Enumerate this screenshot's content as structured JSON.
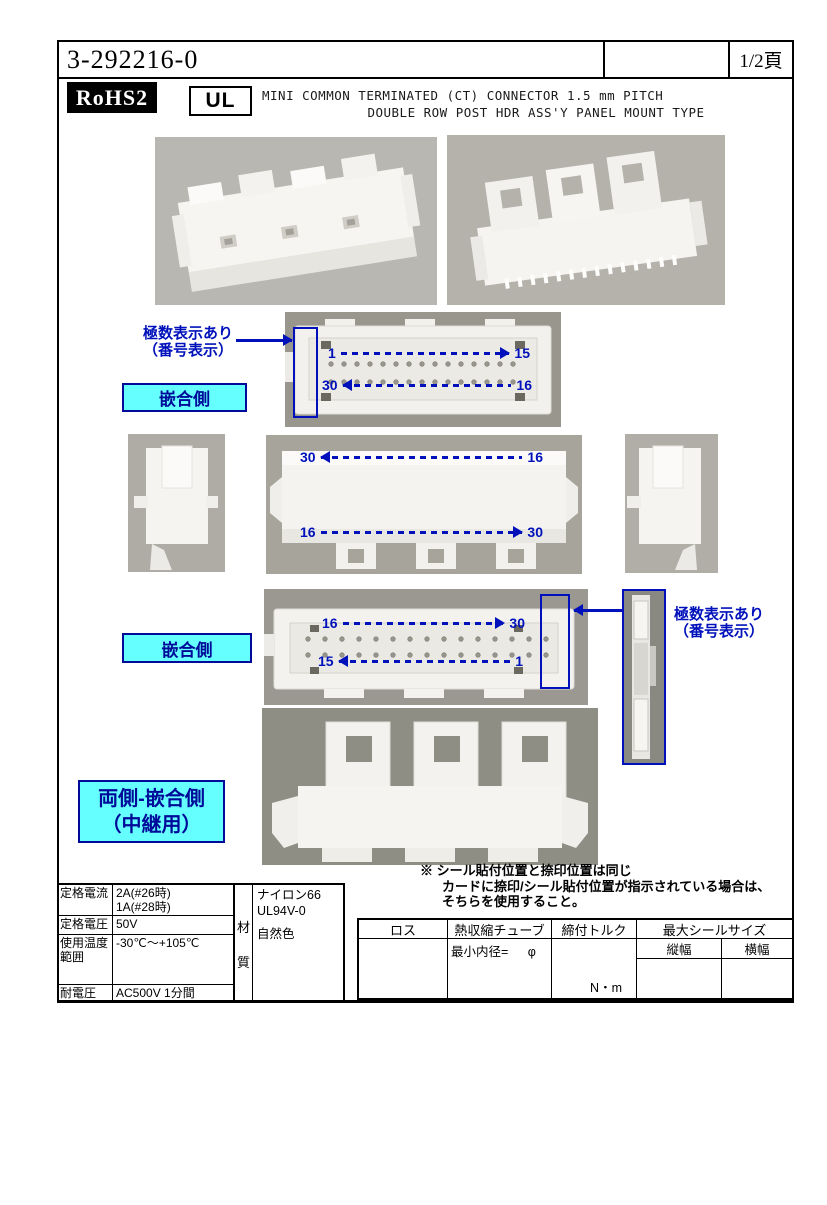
{
  "colors": {
    "accent_blue": "#0011bb",
    "cyan_fill": "#66ffff",
    "page_bg": "#ffffff"
  },
  "header": {
    "part_number": "3-292216-0",
    "page_label": "1/2頁"
  },
  "title_block": {
    "rohs": "RoHS2",
    "ul": "UL",
    "line1": "MINI COMMON TERMINATED (CT) CONNECTOR 1.5 mm PITCH",
    "line2": "DOUBLE ROW POST HDR ASS'Y PANEL MOUNT TYPE"
  },
  "annotations": {
    "pole_marking_line1": "極数表示あり",
    "pole_marking_line2": "（番号表示）",
    "mating_side": "嵌合側",
    "both_sides_line1": "両側-嵌合側",
    "both_sides_line2": "（中継用）"
  },
  "pins": {
    "face1_top_start": "1",
    "face1_top_end": "15",
    "face1_bottom_start": "30",
    "face1_bottom_end": "16",
    "middle_top_start": "30",
    "middle_top_end": "16",
    "middle_bottom_start": "16",
    "middle_bottom_end": "30",
    "face2_top_start": "16",
    "face2_top_end": "30",
    "face2_bottom_start": "15",
    "face2_bottom_end": "1"
  },
  "note": {
    "line1": "※ シール貼付位置と捺印位置は同じ",
    "line2": "カードに捺印/シール貼付位置が指示されている場合は、",
    "line3": "そちらを使用すること。"
  },
  "spec_table": {
    "rated_current_label": "定格電流",
    "rated_current_value1": "2A(#26時)",
    "rated_current_value2": "1A(#28時)",
    "rated_voltage_label": "定格電圧",
    "rated_voltage_value": "50V",
    "temp_range_label1": "使用温度",
    "temp_range_label2": "範囲",
    "temp_range_value": "-30℃〜+105℃",
    "withstand_voltage_label": "耐電圧",
    "withstand_voltage_value": "AC500V 1分間"
  },
  "material": {
    "label_char1": "材",
    "label_char2": "質",
    "value1": "ナイロン66",
    "value2": "UL94V-0",
    "value3": "自然色"
  },
  "right_table": {
    "col_loss": "ロス",
    "col_heat_shrink": "熱収縮チューブ",
    "min_inner_dia": "最小内径=",
    "phi": "φ",
    "col_torque": "締付トルク",
    "torque_unit": "N・m",
    "col_max_seal": "最大シールサイズ",
    "seal_vertical": "縦幅",
    "seal_horizontal": "横幅"
  }
}
